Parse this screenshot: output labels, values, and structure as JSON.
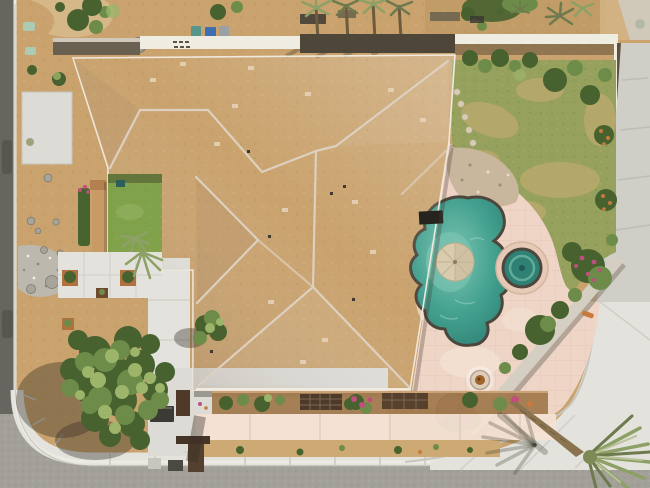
{
  "meta": {
    "caption": "Aerial drone view of a single-family desert home on a corner lot: large tan clay-tile hip roof, interior grass atrium, backyard free-form pool with umbrella-shaded tanning shelf and round spa, patchy lawn, salmon pool deck, diagonal planter wall with bougainvillea, desert front yard with boulders and a large shade tree, curved corner sidewalk, streets on the left and bottom, and a leaning palm tree over the bottom-right driveway.",
    "type": "aerial-photograph"
  },
  "colors": {
    "dirt_base": "#c9a26d",
    "path_sand": "#d6b98b",
    "dirt_dark": "#b08a52",
    "roof_base": "#c9a08e",
    "roof_tile_dark": "#b68878",
    "roof_tile_light": "#e0bfa4",
    "roof_tile_pink": "#d2a391",
    "roof_tile_pale": "#e6d2b8",
    "ridge_cap": "#ddd0c0",
    "eave_line": "#efe7da",
    "concrete": "#dcdbd5",
    "sidewalk": "#e3e2dc",
    "concrete_dim": "#cfcec7",
    "street_light": "#a3a09a",
    "street_dark": "#67655f",
    "curb": "#eceae3",
    "grass_court": "#7fa24a",
    "grass_lawn": "#95a15c",
    "lawn_patch": "#bba96d",
    "hedge_dark": "#47632e",
    "tree_dark": "#47622f",
    "tree_green": "#6d8c4a",
    "tree_light": "#9cb56a",
    "palm_green": "#8da065",
    "palm_dark": "#6d7a4d",
    "trunk_brown": "#8a744f",
    "pool_water": "#45a290",
    "pool_water_light": "#7cc4b2",
    "pool_water_dark": "#2e8174",
    "pool_coping": "#4d463c",
    "deck_salmon": "#eed5c6",
    "deck_light": "#f4e2d4",
    "umbrella_tan": "#d9cbad",
    "rock_tan": "#c8b79d",
    "boulder_gray": "#a9a49a",
    "gravel_gray": "#bdb8ad",
    "wall_lit": "#efece1",
    "wall_shadow": "#4e4639",
    "planter_wall": "#d5cfc3",
    "bougainvillea": "#c04f7e",
    "flower_orange": "#c77b3c",
    "terracotta": "#b0713f",
    "bin_teal": "#55958b",
    "bin_blue": "#3f6fae",
    "bin_gray": "#9aa0a3",
    "mint": "#abcbb4",
    "spa_deck": "#e6c9b6",
    "wood_dark": "#4f3a2a",
    "box_dark": "#3c3a34",
    "shadow": "rgba(52,44,36,0.38)"
  },
  "features": [
    {
      "name": "tile-roof",
      "label": "Tan clay tile hip roof with light ridge caps"
    },
    {
      "name": "atrium-courtyard",
      "label": "Interior grass courtyard with palm and hedge"
    },
    {
      "name": "pool",
      "label": "Free-form pool with tan umbrella over shelf"
    },
    {
      "name": "spa",
      "label": "Round raised spa beside pool"
    },
    {
      "name": "fire-pit",
      "label": "Round fire pit on patio"
    },
    {
      "name": "lawn",
      "label": "Patchy back lawn with stepping stones"
    },
    {
      "name": "leaning-palm",
      "label": "Leaning palm tree over driveway"
    },
    {
      "name": "shade-tree",
      "label": "Large front-yard shade tree"
    },
    {
      "name": "corner-streets",
      "label": "Corner lot streets and curved sidewalk"
    },
    {
      "name": "trash-bins",
      "label": "Teal, blue and gray bins behind rear wall"
    }
  ]
}
